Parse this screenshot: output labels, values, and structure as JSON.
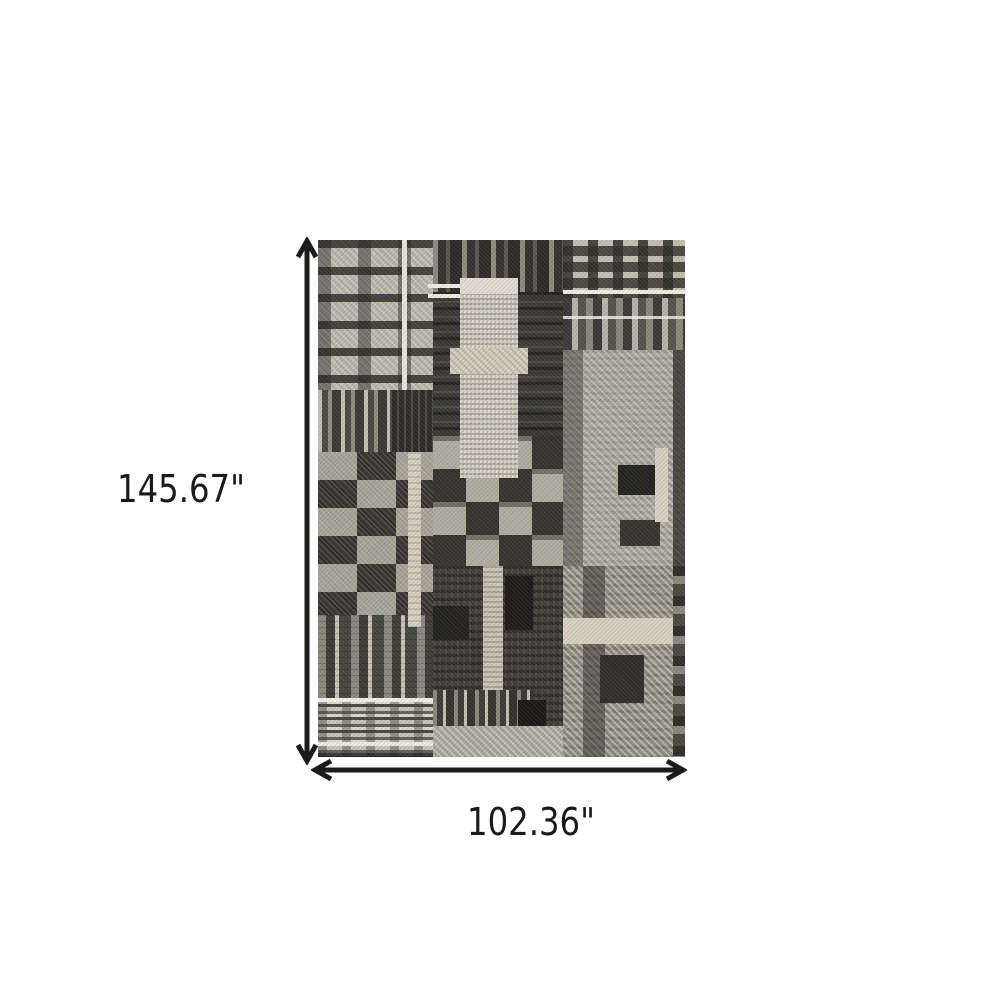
{
  "diagram": {
    "height_label": "145.67\"",
    "width_label": "102.36\"",
    "arrow_color": "#1c1c1c",
    "background_color": "#ffffff"
  },
  "rug": {
    "alt": "Black grey and ivory patchwork plaid area rug",
    "palette": {
      "black": "#201f1c",
      "charcoal": "#3b3a34",
      "grey": "#6f6d64",
      "light_grey": "#b3b0a4",
      "cream": "#d8d3c3",
      "ivory": "#f1eee3"
    }
  }
}
